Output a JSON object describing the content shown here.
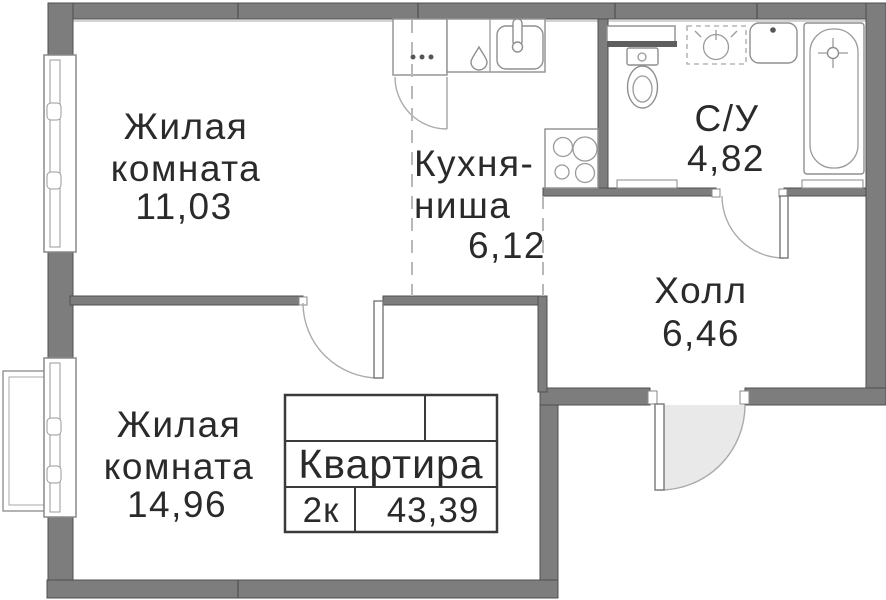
{
  "rooms": [
    {
      "key": "living-room-1",
      "lines": [
        "Жилая",
        "комната"
      ],
      "area": "11,03"
    },
    {
      "key": "kitchen-niche",
      "lines": [
        "Кухня-",
        "ниша"
      ],
      "area": "6,12"
    },
    {
      "key": "bathroom",
      "lines": [
        "С/У"
      ],
      "area": "4,82"
    },
    {
      "key": "hall",
      "lines": [
        "Холл"
      ],
      "area": "6,46"
    },
    {
      "key": "living-room-2",
      "lines": [
        "Жилая",
        "комната"
      ],
      "area": "14,96"
    }
  ],
  "stamp": {
    "title": "Квартира",
    "rooms_count": "2к",
    "total_area": "43,39"
  },
  "fixtures": [
    "window",
    "balcony-basket",
    "wardrobe-cabinet",
    "water-drop",
    "kitchen-sink",
    "stove",
    "ventilation-box",
    "toilet",
    "washing-machine-place",
    "washbasin",
    "bathtub",
    "interior-door",
    "entrance-door"
  ],
  "colors": {
    "wall": "#7d7d7d",
    "wall_edge": "#4f4f4f",
    "fixture_line": "#8f8f8f",
    "door_arc": "#ababab",
    "door_swing_fill": "#e9e9e9",
    "dashed_zone_line": "#b8b8b8",
    "stamp_border": "#3a3a3a",
    "text": "#2a2a2a"
  }
}
